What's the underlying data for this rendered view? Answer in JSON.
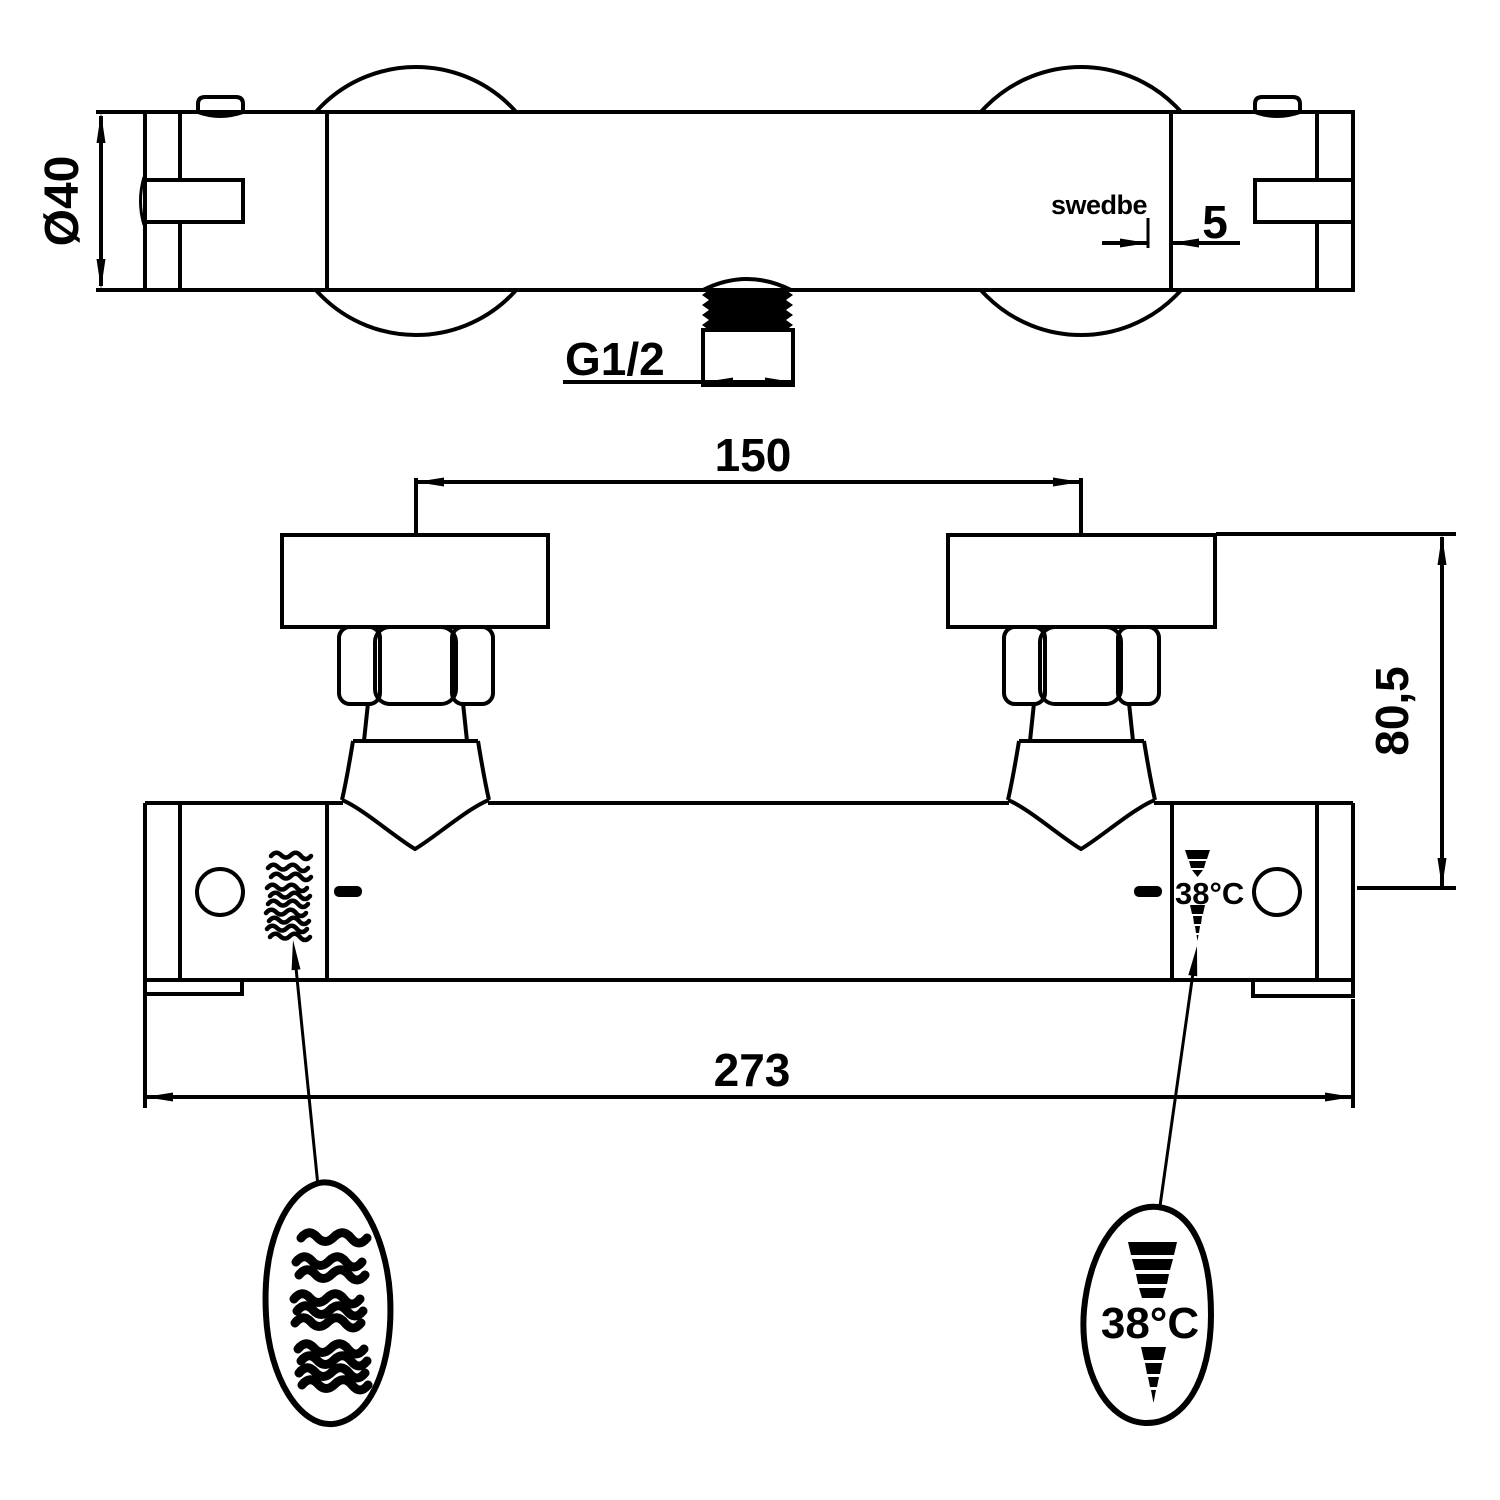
{
  "drawing": {
    "brand": "swedbe",
    "dimensions": {
      "diameter": "Ø40",
      "brand_offset": "5",
      "thread": "G1/2",
      "port_spacing": "150",
      "wall_height": "80,5",
      "overall_length": "273"
    },
    "markings": {
      "temp_body": "38°C",
      "temp_balloon": "38°C"
    },
    "symbols": {
      "hot_water": "wavy-lines-symbol",
      "temperature_scale": "stepped-cone-symbol"
    },
    "colors": {
      "line": "#000000",
      "background": "#ffffff"
    }
  }
}
